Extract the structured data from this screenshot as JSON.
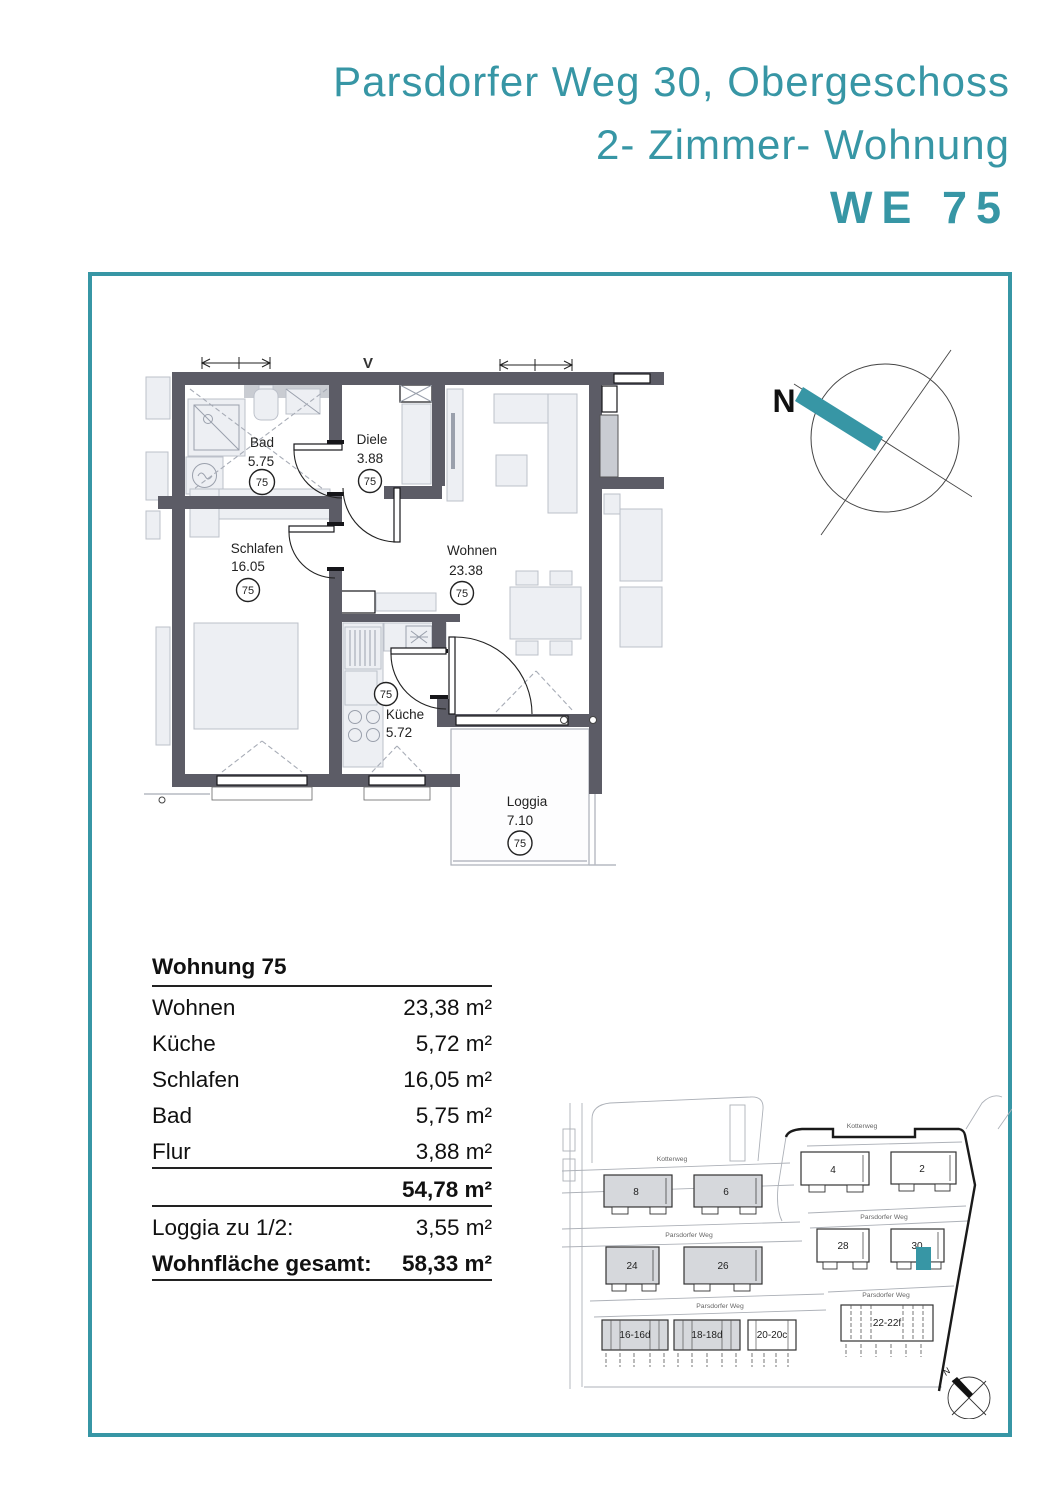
{
  "colors": {
    "accent": "#3796A5",
    "wall_gray": "#5C5C66"
  },
  "title": {
    "line1": "Parsdorfer Weg 30, Obergeschoss",
    "line2": "2- Zimmer- Wohnung",
    "line3": "WE 75"
  },
  "floorplan": {
    "section_marker": "V",
    "compass_label": "N",
    "rooms": [
      {
        "name": "Bad",
        "area": "5.75",
        "unit": "75"
      },
      {
        "name": "Diele",
        "area": "3.88",
        "unit": "75"
      },
      {
        "name": "Schlafen",
        "area": "16.05",
        "unit": "75"
      },
      {
        "name": "Wohnen",
        "area": "23.38",
        "unit": "75"
      },
      {
        "name": "Küche",
        "area": "5.72",
        "unit": "75"
      },
      {
        "name": "Loggia",
        "area": "7.10",
        "unit": "75"
      }
    ]
  },
  "area_table": {
    "title": "Wohnung 75",
    "rows": [
      {
        "label": "Wohnen",
        "value": "23,38 m²"
      },
      {
        "label": "Küche",
        "value": "5,72 m²"
      },
      {
        "label": "Schlafen",
        "value": "16,05 m²"
      },
      {
        "label": "Bad",
        "value": "5,75 m²"
      },
      {
        "label": "Flur",
        "value": "3,88 m²"
      }
    ],
    "subtotal_value": "54,78 m²",
    "loggia_label": "Loggia zu 1/2:",
    "loggia_value": "3,55 m²",
    "total_label": "Wohnfläche gesamt:",
    "total_value": "58,33 m²"
  },
  "site_plan": {
    "compass_label": "N",
    "street_labels": [
      {
        "name": "Kotterweg"
      },
      {
        "name": "Kotterweg"
      },
      {
        "name": "Parsdorfer Weg"
      },
      {
        "name": "Parsdorfer Weg"
      },
      {
        "name": "Parsdorfer Weg"
      },
      {
        "name": "Parsdorfer Weg"
      }
    ],
    "buildings": [
      {
        "label": "8"
      },
      {
        "label": "6"
      },
      {
        "label": "4"
      },
      {
        "label": "2"
      },
      {
        "label": "24"
      },
      {
        "label": "26"
      },
      {
        "label": "28"
      },
      {
        "label": "30"
      }
    ],
    "parking": [
      {
        "label": "16-16d"
      },
      {
        "label": "18-18d"
      },
      {
        "label": "20-20c"
      },
      {
        "label": "22-22f"
      }
    ],
    "highlighted_building": "30"
  }
}
